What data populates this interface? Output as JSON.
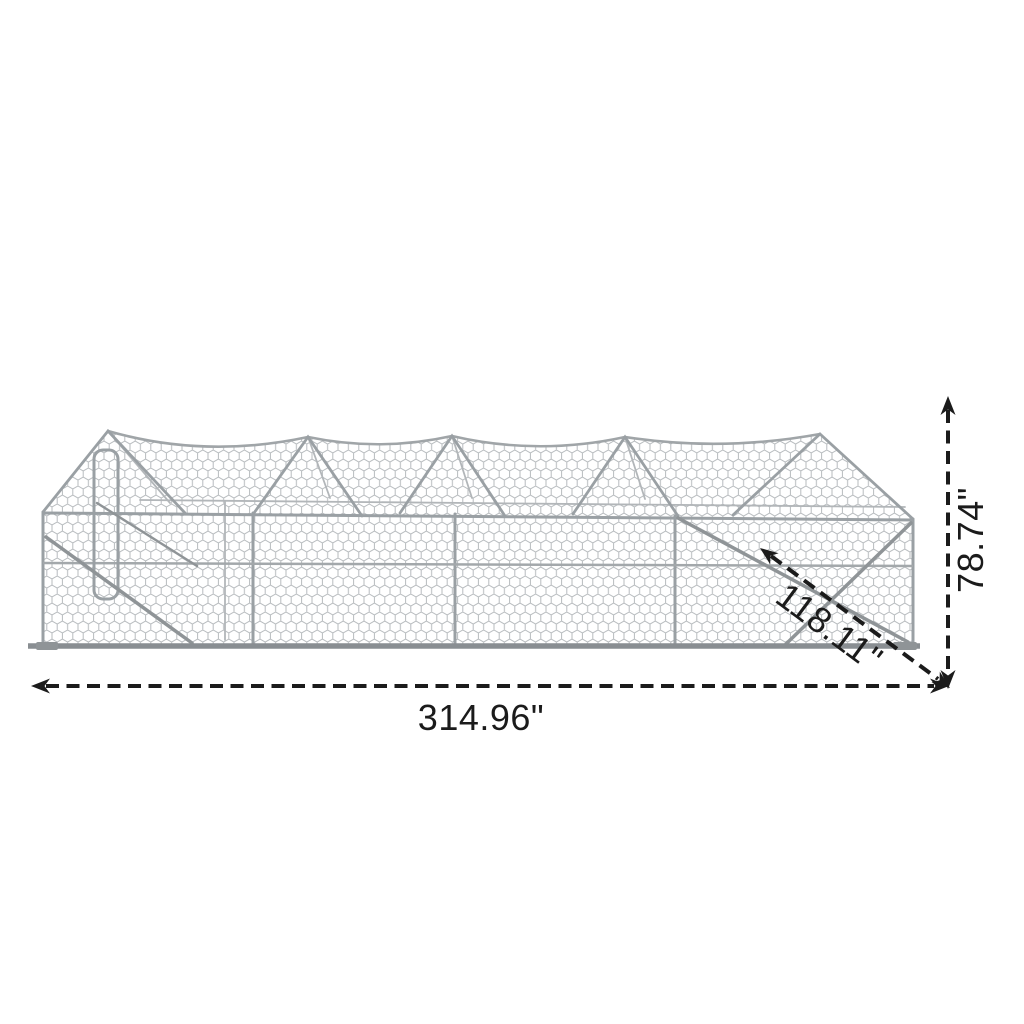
{
  "diagram": {
    "kind": "product-dimension-diagram",
    "subject": "walk-in-wire-mesh-chicken-run-cage"
  },
  "dimensions": {
    "width_label": "314.96\"",
    "height_label": "78.74\"",
    "depth_label": "118.11\""
  },
  "colors": {
    "background": "#ffffff",
    "dimension_line": "#1b1b1b",
    "frame_pole": "#9aa0a4",
    "frame_dark": "#8f9497",
    "mesh_wire": "#b7bbbe"
  }
}
